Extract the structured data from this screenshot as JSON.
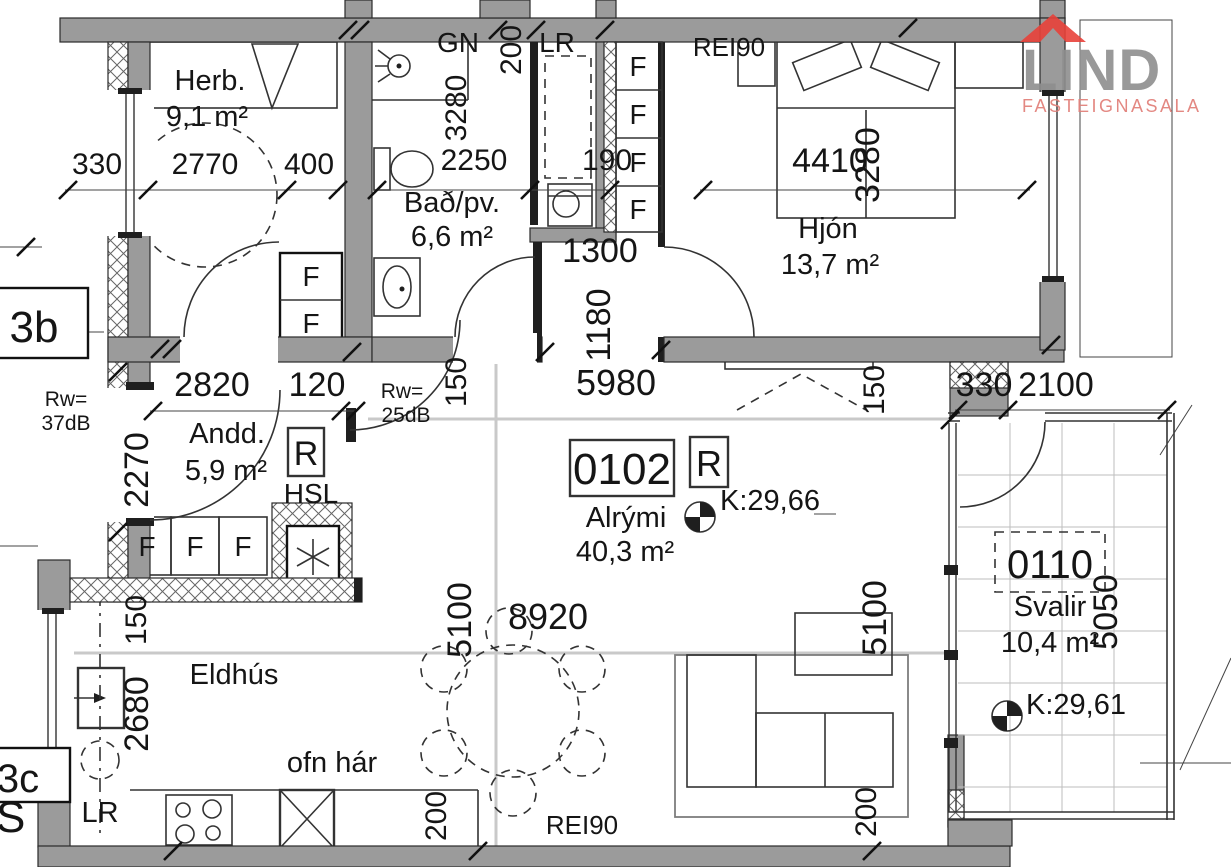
{
  "logo": {
    "brand": "LIND",
    "tagline": "FASTEIGNASALA"
  },
  "unit": {
    "number": "0102",
    "category": "R",
    "level": "K:29,66",
    "name": "Alrými",
    "area": "40,3 m²"
  },
  "rooms": {
    "herb": {
      "name": "Herb.",
      "area": "9,1 m²"
    },
    "bad": {
      "name": "Bað/pv.",
      "area": "6,6 m²"
    },
    "hjon": {
      "name": "Hjón",
      "area": "13,7 m²"
    },
    "andd": {
      "name": "Andd.",
      "area": "5,9 m²"
    },
    "eldhus": {
      "name": "Eldhús"
    },
    "svalir": {
      "number": "0110",
      "name": "Svalir",
      "area": "10,4 m²",
      "level": "K:29,61"
    }
  },
  "labels": {
    "gn": "GN",
    "lr": "LR",
    "hsl": "HSL",
    "r": "R",
    "f": "F",
    "rei90": "REI90",
    "ofn_har": "ofn hár",
    "rw37_1": "Rw=",
    "rw37_2": "37dB",
    "rw25_1": "Rw=",
    "rw25_2": "25dB",
    "neighbor_3b": "3b",
    "neighbor_3c": "3c",
    "neighbor_s": "S"
  },
  "dims": {
    "herb_left": "330",
    "herb_width": "2770",
    "herb_right": "400",
    "bad_height": "3280",
    "bad_width": "2250",
    "lr_width": "200",
    "lr_wall": "190",
    "hall_width": "1300",
    "hall_depth": "1180",
    "main_width": "5980",
    "hjon_width": "4410",
    "hjon_height": "3280",
    "andd_width": "2820",
    "andd_jamb": "120",
    "andd_height": "2270",
    "alrymi_width": "8920",
    "alrymi_height": "5100",
    "eldhus_height": "2680",
    "svalir_left": "330",
    "svalir_width": "2100",
    "svalir_height": "5050",
    "d150": "150",
    "d200": "200"
  }
}
